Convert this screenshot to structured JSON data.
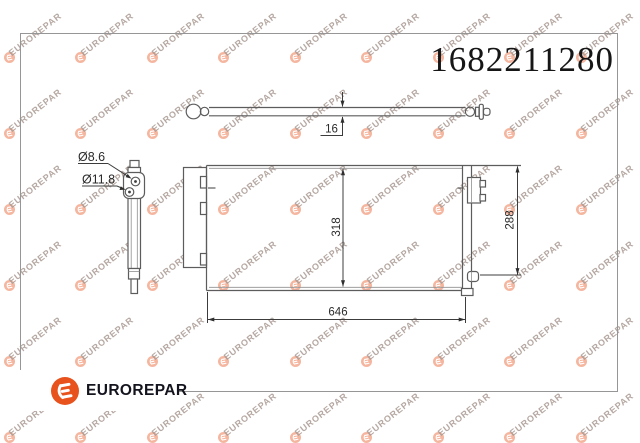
{
  "part_number": "1682211280",
  "brand": {
    "name": "EUROREPAR"
  },
  "watermark": {
    "text": "EUROREPAR"
  },
  "dimensions": {
    "tube_diameter": "16",
    "hole_small": "Ø8.6",
    "hole_large": "Ø11.8",
    "core_height": "318",
    "right_height": "288",
    "core_width": "646"
  },
  "colors": {
    "logo_orange": "#e8521d",
    "watermark_salmon": "#e8765a",
    "line_gray": "#5c5c5c"
  }
}
